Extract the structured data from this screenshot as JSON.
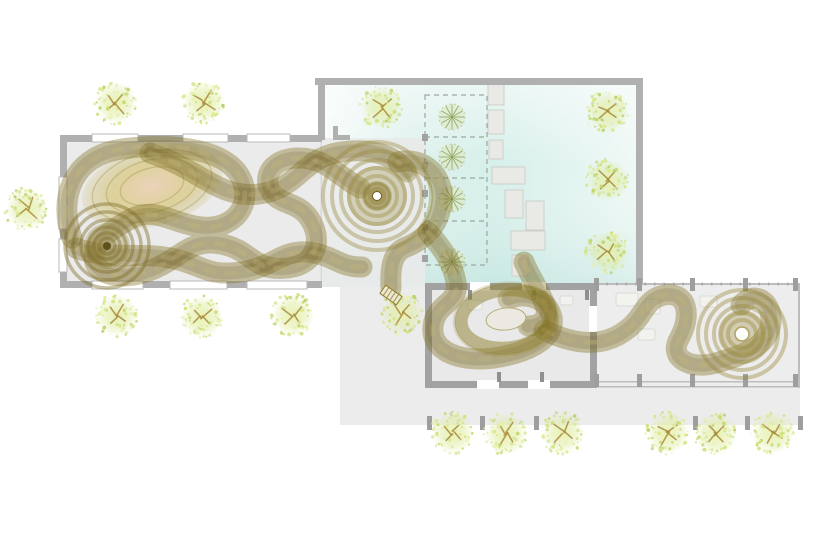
{
  "meta": {
    "type": "architectural-site-plan",
    "canvas": {
      "width": 818,
      "height": 546
    }
  },
  "palette": {
    "background": "#ffffff",
    "wall": "#b0b0b0",
    "wall_dark": "#a2a2a2",
    "jamb": "#8f8f8f",
    "floor_hall": "#ebebeb",
    "floor_wing": "#e9e9e9",
    "floor_colonnade": "#ededed",
    "plaza": "#ececec",
    "window_fill": "#ffffff",
    "window_border": "#b9b9b9",
    "stone_fill": "#e9e9e6",
    "stone_border": "#cfcfca",
    "column": "#9e9e9e",
    "dash_line": "#9aa8a0",
    "furniture_fill": "#f3f3f0",
    "furniture_border": "#d7d7d2",
    "ribbon_main": "#8e7d2b",
    "ribbon_dark": "#6a5a20",
    "ribbon_light": "#c9bd86",
    "ribbon_core": "#97863a",
    "nest_line": "#8a7930",
    "nest_dark": "#52450f",
    "tree_dots": [
      "#dbe98a",
      "#cfe276",
      "#c3d667",
      "#e6f0a8",
      "#b9cf66",
      "#d8e59c"
    ],
    "tree_branch": "#a5873a",
    "small_tree_spoke": "#94ab66",
    "small_tree_fill": "#dce6c0",
    "courtyard_stops": [
      [
        "0%",
        "#f7fbfa"
      ],
      [
        "28%",
        "#def1ed"
      ],
      [
        "55%",
        "#d6efea"
      ],
      [
        "80%",
        "#e3f4f1"
      ],
      [
        "100%",
        "#eef8f5"
      ]
    ],
    "courtyard_overlay_stops": [
      [
        "0%",
        "rgba(255,255,255,0.5)"
      ],
      [
        "40%",
        "rgba(255,255,255,0)"
      ],
      [
        "100%",
        "rgba(167,214,206,0.30)"
      ]
    ],
    "tree_grad_stops": [
      [
        "0%",
        "rgba(233,243,173,0.95)"
      ],
      [
        "60%",
        "rgba(221,235,157,0.45)"
      ],
      [
        "100%",
        "rgba(221,235,157,0)"
      ]
    ],
    "pad_grad_stops": [
      [
        "0%",
        "#ead0b4"
      ],
      [
        "55%",
        "#dccf92"
      ],
      [
        "100%",
        "rgba(204,189,120,0.2)"
      ]
    ]
  },
  "plaza": {
    "x": 340,
    "y": 287,
    "w": 460,
    "h": 138,
    "wall_strip": {
      "x": 322,
      "y": 281,
      "w": 108,
      "h": 6
    }
  },
  "left_hall": {
    "x": 60,
    "y": 135,
    "w": 262,
    "h": 153,
    "wall": 7,
    "windows_top": [
      {
        "x": 92,
        "w": 46
      },
      {
        "x": 183,
        "w": 45
      },
      {
        "x": 247,
        "w": 43
      }
    ],
    "windows_left": [
      {
        "y": 177,
        "h": 52
      },
      {
        "y": 239,
        "h": 33
      }
    ],
    "windows_bottom": [
      {
        "x": 92,
        "w": 51
      },
      {
        "x": 170,
        "w": 57
      },
      {
        "x": 247,
        "w": 60
      }
    ]
  },
  "courtyard": {
    "x": 322,
    "y": 85,
    "w": 314,
    "h": 202,
    "wall_top": {
      "x": 315,
      "y": 78,
      "w": 328,
      "h": 7
    },
    "wall_right": {
      "x": 636,
      "y": 85,
      "w": 7,
      "h": 202
    },
    "wall_stub": {
      "x": 318,
      "y": 85,
      "w": 7,
      "h": 55
    },
    "notch": [
      {
        "x": 333,
        "y": 126,
        "w": 5,
        "h": 14
      },
      {
        "x": 333,
        "y": 135,
        "w": 17,
        "h": 5
      }
    ],
    "entry_floor": {
      "x": 322,
      "y": 138,
      "w": 103,
      "h": 149
    }
  },
  "planting_strip": {
    "x": 425,
    "y": 95,
    "w": 62,
    "h": 170,
    "dividers_y": [
      137,
      178,
      221
    ],
    "posts_y": [
      134,
      162,
      190,
      224,
      255
    ],
    "small_trees": [
      {
        "x": 452,
        "y": 117
      },
      {
        "x": 452,
        "y": 157
      },
      {
        "x": 452,
        "y": 199
      },
      {
        "x": 452,
        "y": 262
      }
    ],
    "small_tree_r": 13
  },
  "stepping_stones": [
    {
      "x": 488,
      "y": 83,
      "w": 16,
      "h": 22
    },
    {
      "x": 488,
      "y": 110,
      "w": 16,
      "h": 24
    },
    {
      "x": 489,
      "y": 140,
      "w": 14,
      "h": 19
    },
    {
      "x": 492,
      "y": 167,
      "w": 33,
      "h": 17
    },
    {
      "x": 505,
      "y": 190,
      "w": 18,
      "h": 28
    },
    {
      "x": 526,
      "y": 201,
      "w": 18,
      "h": 29
    },
    {
      "x": 511,
      "y": 231,
      "w": 34,
      "h": 19
    },
    {
      "x": 512,
      "y": 255,
      "w": 16,
      "h": 21
    }
  ],
  "south_wing": {
    "hall": {
      "x": 425,
      "y": 283,
      "w": 172,
      "h": 105,
      "wall": 7,
      "gaps_top": [
        {
          "x": 470,
          "w": 20
        },
        {
          "x": 522,
          "w": 24
        }
      ],
      "gaps_bottom": [
        {
          "x": 477,
          "w": 22
        },
        {
          "x": 528,
          "w": 22
        }
      ],
      "gap_right": {
        "y": 306,
        "h": 26
      },
      "jambs": [
        {
          "x": 468,
          "y": 290
        },
        {
          "x": 532,
          "y": 290
        },
        {
          "x": 585,
          "y": 290
        },
        {
          "x": 497,
          "y": 372
        },
        {
          "x": 540,
          "y": 372
        }
      ]
    },
    "colonnade": {
      "x": 597,
      "y": 283,
      "w": 203,
      "h": 105,
      "columns_x": [
        637,
        690,
        743,
        793
      ],
      "corner_x": 594
    }
  },
  "terrace_columns": {
    "xs": [
      427,
      480,
      534,
      693,
      745,
      798
    ],
    "y": 416
  },
  "furniture": [
    {
      "x": 616,
      "y": 293,
      "w": 22,
      "h": 13
    },
    {
      "x": 645,
      "y": 299,
      "w": 15,
      "h": 15
    },
    {
      "x": 700,
      "y": 296,
      "w": 17,
      "h": 11
    },
    {
      "x": 753,
      "y": 299,
      "w": 19,
      "h": 13
    },
    {
      "x": 638,
      "y": 329,
      "w": 17,
      "h": 11
    },
    {
      "x": 758,
      "y": 328,
      "w": 15,
      "h": 11
    },
    {
      "x": 468,
      "y": 300,
      "w": 14,
      "h": 10
    },
    {
      "x": 560,
      "y": 296,
      "w": 13,
      "h": 9
    }
  ],
  "trees": {
    "radius": 21,
    "positions": [
      {
        "x": 116,
        "y": 103
      },
      {
        "x": 204,
        "y": 102
      },
      {
        "x": 27,
        "y": 209
      },
      {
        "x": 382,
        "y": 107
      },
      {
        "x": 608,
        "y": 112
      },
      {
        "x": 608,
        "y": 180
      },
      {
        "x": 608,
        "y": 252
      },
      {
        "x": 117,
        "y": 316
      },
      {
        "x": 202,
        "y": 317
      },
      {
        "x": 293,
        "y": 315
      },
      {
        "x": 402,
        "y": 313
      },
      {
        "x": 453,
        "y": 433
      },
      {
        "x": 506,
        "y": 434
      },
      {
        "x": 563,
        "y": 433
      },
      {
        "x": 668,
        "y": 433
      },
      {
        "x": 716,
        "y": 434
      },
      {
        "x": 773,
        "y": 433
      }
    ]
  },
  "ribbon": {
    "paths": [
      "M 72,238 C 58,198 72,156 122,149 C 174,142 232,149 243,183 C 252,211 227,233 195,226 C 166,220 152,206 127,221 C 110,231 99,238 95,251 C 88,274 119,282 149,271 C 181,259 189,238 221,244 C 253,250 252,272 288,268 C 318,264 323,238 309,218 C 297,200 277,206 269,188 C 263,171 277,158 299,158 C 326,158 338,176 360,188",
      "M 150,153 C 202,170 218,199 259,194 C 299,189 301,158 341,152 C 378,147 396,158 407,172",
      "M 398,162 C 424,156 444,176 442,200 C 440,226 424,240 404,248 C 392,254 390,268 391,288",
      "M 76,248 C 108,260 138,252 170,258 C 202,264 206,277 241,272 C 272,268 281,250 307,252 C 332,254 340,268 362,267",
      "M 428,232 C 444,250 452,262 456,282 C 460,304 436,302 433,326 C 430,352 462,364 500,357 C 537,350 558,334 551,314 C 545,297 524,292 508,299",
      "M 524,262 C 530,276 538,288 544,302 C 550,316 544,326 528,326",
      "M 544,330 C 576,346 602,346 622,333 C 646,318 642,300 664,295 C 688,291 692,316 679,339 C 668,359 692,370 716,363 C 744,355 773,345 771,317 C 769,298 752,292 741,305"
    ],
    "nests": {
      "oval_pad": {
        "cx": 152,
        "cy": 186,
        "rx": 72,
        "ry": 40,
        "rot": -15
      },
      "vortex": {
        "cx": 107,
        "cy": 246,
        "radii": [
          42,
          34,
          26,
          19,
          13,
          8
        ]
      },
      "galaxy": {
        "cx": 377,
        "cy": 196,
        "radii": [
          54,
          45,
          36,
          28,
          20,
          13,
          7
        ],
        "dot_r": 4.5
      },
      "ring": {
        "cx": 506,
        "cy": 319,
        "rx": 45,
        "ry": 29,
        "hole_rx": 20,
        "hole_ry": 11,
        "rot": -6
      },
      "swirl": {
        "cx": 742,
        "cy": 334,
        "radii": [
          44,
          36,
          28,
          21,
          14
        ],
        "dot_r": 7
      }
    },
    "end_cap": {
      "x": 391,
      "y": 295,
      "rot": 35
    }
  }
}
